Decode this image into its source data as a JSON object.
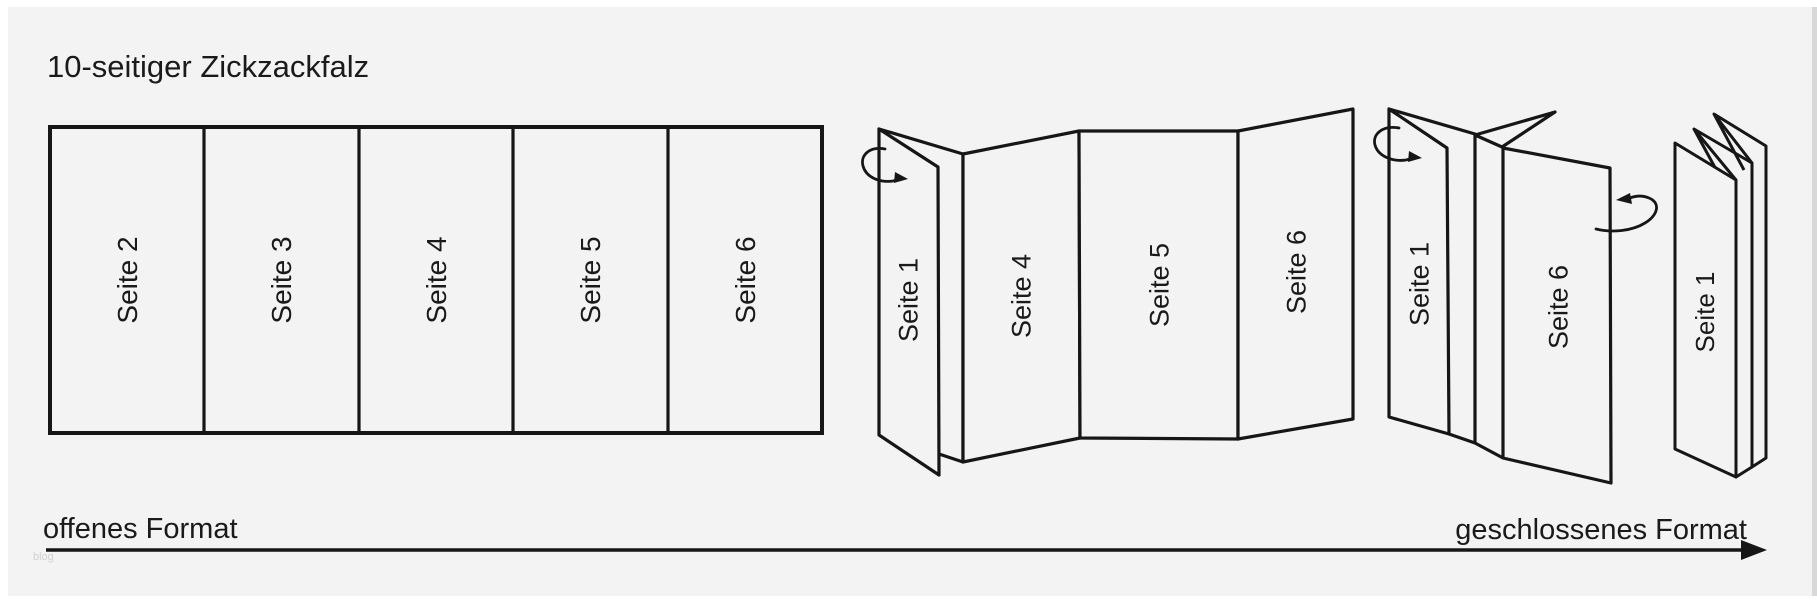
{
  "title": "10-seitiger Zickzackfalz",
  "watermark": "blog",
  "colors": {
    "background": "#f3f3f3",
    "page_margin": "#ffffff",
    "right_edge_strip": "#d8d8d8",
    "ink": "#161616",
    "text": "#1a1a1a",
    "watermark": "#d2d2d2"
  },
  "figures": {
    "open_flat": {
      "description": "flat sheet with five visible panels",
      "panels": [
        "Seite 2",
        "Seite 3",
        "Seite 4",
        "Seite 5",
        "Seite 6"
      ]
    },
    "half_folded": {
      "description": "first zigzag fold step, front flap folding over",
      "panels": [
        "Seite 1",
        "Seite 4",
        "Seite 5",
        "Seite 6"
      ]
    },
    "nearly_folded": {
      "description": "second fold step, two wings around spine",
      "panels": [
        "Seite 1",
        "Seite 6"
      ]
    },
    "fully_folded": {
      "description": "closed zigzag-folded stack",
      "panels": [
        "Seite 1"
      ]
    }
  },
  "axis": {
    "left_label": "offenes Format",
    "right_label": "geschlossenes Format"
  }
}
